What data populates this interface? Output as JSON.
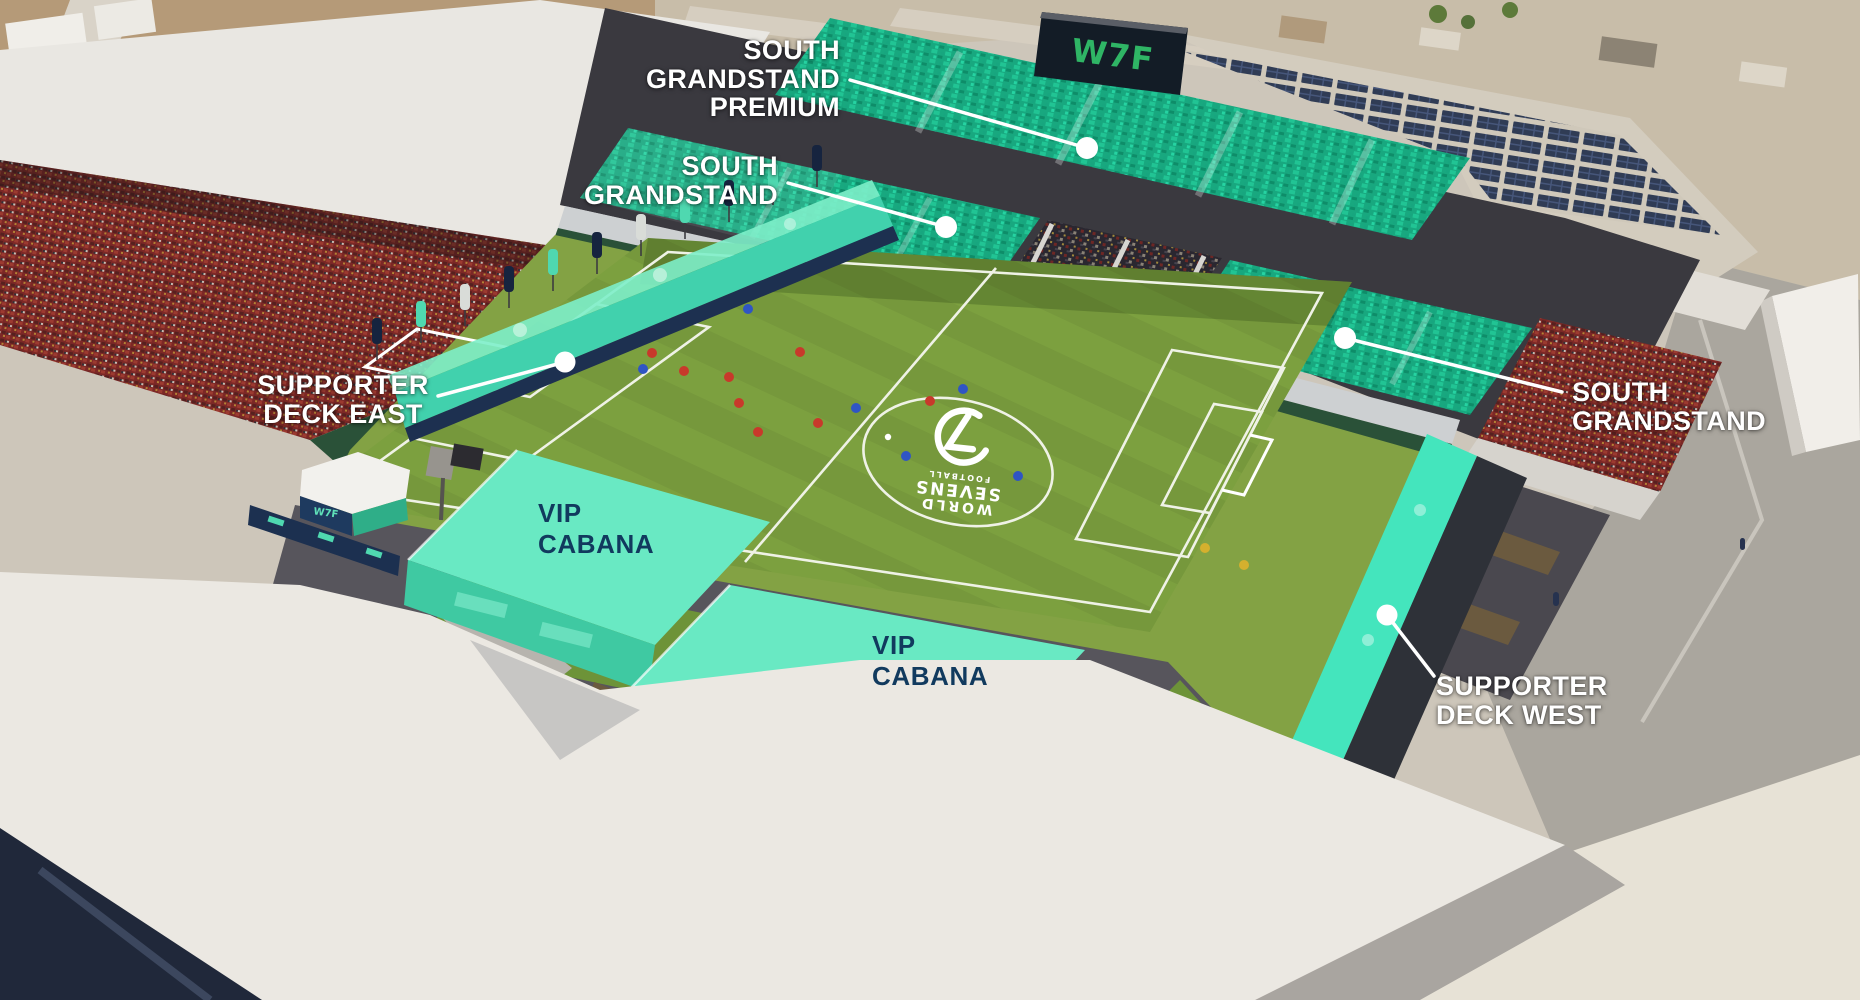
{
  "colors": {
    "highlight_teal": "#1bb68b",
    "cabana_mint": "#69e9c3",
    "deck_teal": "#2fe2b6",
    "pitch_green": "#7ca03f",
    "apron_green": "#83a244",
    "seats_red": "#7c2826",
    "scoreboard_bg": "#131c26",
    "scoreboard_logo_green": "#2fb565",
    "callout_text": "#ffffff",
    "cabana_label_navy": "#113a5e",
    "hoarding_green": "#2a5138"
  },
  "branding": {
    "scoreboard_logo": "W7F",
    "tent_logo": "W7F",
    "small_tent_logo": "W7F",
    "center_logo_lines": [
      "WORLD",
      "SEVENS",
      "FOOTBALL"
    ]
  },
  "zones": {
    "south_grandstand_premium": {
      "label_lines": [
        "SOUTH",
        "GRANDSTAND",
        "PREMIUM"
      ]
    },
    "south_grandstand_upper": {
      "label_lines": [
        "SOUTH",
        "GRANDSTAND"
      ]
    },
    "supporter_deck_east": {
      "label_lines": [
        "SUPPORTER",
        "DECK EAST"
      ]
    },
    "vip_cabana_east": {
      "label_lines": [
        "VIP",
        "CABANA"
      ]
    },
    "vip_cabana_west": {
      "label_lines": [
        "VIP",
        "CABANA"
      ]
    },
    "south_grandstand_right": {
      "label_lines": [
        "SOUTH",
        "GRANDSTAND"
      ]
    },
    "supporter_deck_west": {
      "label_lines": [
        "SUPPORTER",
        "DECK WEST"
      ]
    }
  }
}
